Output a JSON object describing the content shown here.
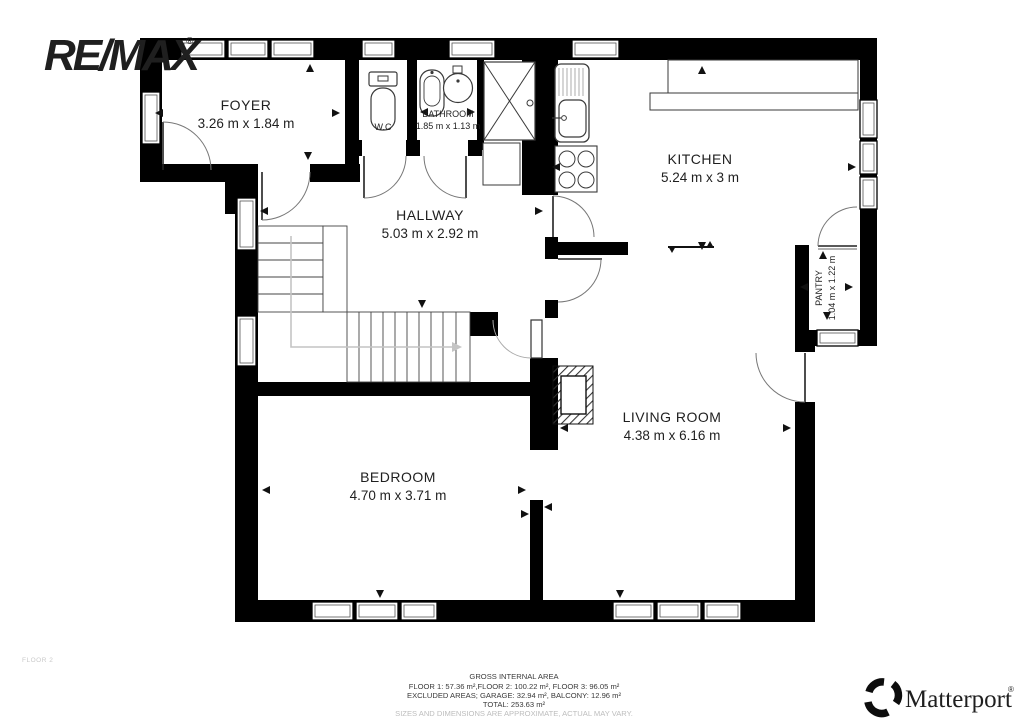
{
  "branding": {
    "remax_logo": "RE/MAX",
    "matterport_logo": "Matterport",
    "registered_mark": "®"
  },
  "floor_label": "FLOOR 2",
  "rooms": {
    "foyer": {
      "name": "FOYER",
      "dims": "3.26 m x 1.84 m"
    },
    "wc": {
      "name": "W.C"
    },
    "bathroom": {
      "name": "BATHROOM",
      "dims": "1.85 m x 1.13 m"
    },
    "kitchen": {
      "name": "KITCHEN",
      "dims": "5.24 m x 3 m"
    },
    "hallway": {
      "name": "HALLWAY",
      "dims": "5.03 m x 2.92 m"
    },
    "pantry": {
      "name": "PANTRY",
      "dims": "1.04 m x 1.22 m"
    },
    "living_room": {
      "name": "LIVING ROOM",
      "dims": "4.38 m x 6.16 m"
    },
    "bedroom": {
      "name": "BEDROOM",
      "dims": "4.70 m x 3.71 m"
    }
  },
  "footer": {
    "title": "GROSS INTERNAL AREA",
    "line1": "FLOOR 1: 57.36 m²,FLOOR 2: 100.22 m², FLOOR 3: 96.05 m²",
    "line2": "EXCLUDED AREAS; GARAGE: 32.94 m², BALCONY: 12.96 m²",
    "line3": "TOTAL: 253.63 m²",
    "disclaimer": "SIZES AND DIMENSIONS ARE APPROXIMATE, ACTUAL MAY VARY."
  },
  "colors": {
    "wall": "#000000",
    "label": "#1f1f1f",
    "muted": "#c9c9c9",
    "footer_text": "#3a3a3a"
  }
}
